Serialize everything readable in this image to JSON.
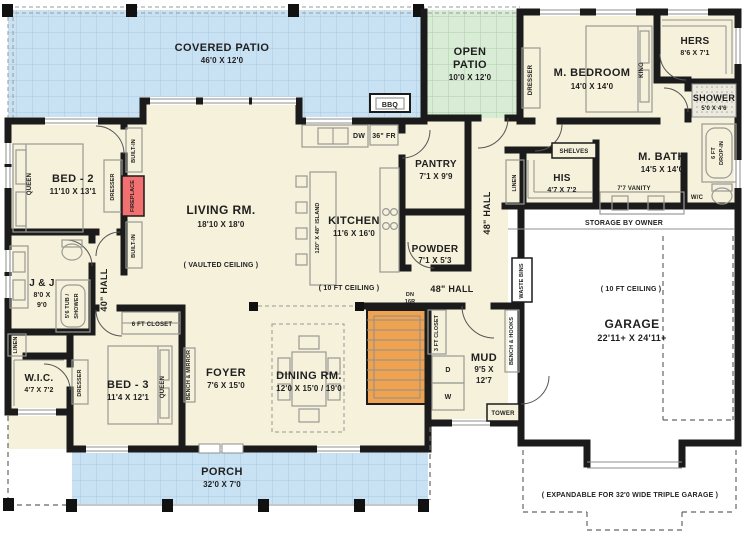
{
  "title": "One-Story House Floor Plan",
  "colors": {
    "patio_blue": "#c9e2f3",
    "patio_blue_grid": "#a6c8e0",
    "open_patio_green": "#d9ecd6",
    "open_patio_grid": "#abd0a6",
    "floor_cream": "#f5f1db",
    "wall_black": "#1b1b1b",
    "stairs_orange": "#efa24f",
    "fireplace_red": "#f37070",
    "garage_white": "#ffffff"
  },
  "rooms": {
    "covered_patio": {
      "name": "COVERED PATIO",
      "dims": "46'0 X 12'0"
    },
    "open_patio": {
      "line1": "OPEN",
      "line2": "PATIO",
      "dims": "10'0 X 12'0"
    },
    "m_bedroom": {
      "name": "M. BEDROOM",
      "dims": "14'0 X 14'0"
    },
    "hers": {
      "name": "HERS",
      "dims": "8'6 X 7'1"
    },
    "shower": {
      "name": "SHOWER",
      "dims": "5'0 X 4'6"
    },
    "m_bath": {
      "name": "M. BATH",
      "dims": "14'5 X 14'0"
    },
    "his": {
      "name": "HIS",
      "dims": "4'7 X 7'2"
    },
    "bed2": {
      "name": "BED - 2",
      "dims": "11'10 X 13'1"
    },
    "living": {
      "name": "LIVING RM.",
      "dims": "18'10 X 18'0",
      "note": "( VAULTED CEILING )"
    },
    "kitchen": {
      "name": "KITCHEN",
      "dims": "11'6 X 16'0"
    },
    "pantry": {
      "name": "PANTRY",
      "dims": "7'1 X 9'9"
    },
    "powder": {
      "name": "POWDER",
      "dims": "7'1 X 5'3"
    },
    "jack_jill": {
      "name": "J & J",
      "dims1": "8'0 X",
      "dims2": "9'0"
    },
    "wic": {
      "name": "W.I.C.",
      "dims": "4'7 X 7'2"
    },
    "bed3": {
      "name": "BED - 3",
      "dims": "11'4 X 12'1"
    },
    "foyer": {
      "name": "FOYER",
      "dims": "7'6 X 15'0"
    },
    "dining": {
      "name": "DINING RM.",
      "dims": "12'0 X 15'0 / 19'0"
    },
    "mud": {
      "name": "MUD",
      "dims1": "9'5 X",
      "dims2": "12'7"
    },
    "garage": {
      "name": "GARAGE",
      "dims": "22'11+ X 24'11+"
    },
    "porch": {
      "name": "PORCH",
      "dims": "32'0 X 7'0"
    }
  },
  "halls": {
    "hall40": "40\" HALL",
    "hall48_master": "48\" HALL",
    "hall48_stairs": "48\" HALL"
  },
  "notes": {
    "ceiling_kitchen": "( 10 FT CEILING )",
    "ceiling_garage": "( 10 FT CEILING )",
    "storage": "STORAGE BY OWNER",
    "expandable": "( EXPANDABLE FOR 32'0 WIDE TRIPLE GARAGE )",
    "stairs_dn": "DN",
    "stairs_risers": "16R"
  },
  "fixtures": {
    "queen_bed2": "QUEEN",
    "dresser_bed2": "DRESSER",
    "builtin_top": "BUILT-IN",
    "builtin_bottom": "BUILT-IN",
    "fireplace": "FIREPLACE",
    "island": "120\" X 48\" ISLAND",
    "dw": "DW",
    "fridge": "36\" FR",
    "bbq": "BBQ",
    "tub_shower_1": "5'6 TUB /",
    "tub_shower_2": "SHOWER",
    "linen_left": "LINEN",
    "linen_right": "LINEN",
    "dresser_bed3": "DRESSER",
    "queen_bed3": "QUEEN",
    "closet6": "6 FT CLOSET",
    "bench_mirror": "BENCH & MIRROR",
    "closet3": "3 FT CLOSET",
    "dryer": "D",
    "washer": "W",
    "tower": "TOWER",
    "bench_hooks": "BENCH & HOOKS",
    "waste_bins": "WASTE BINS",
    "shelves": "SHELVES",
    "vanity": "7'7 VANITY",
    "wc": "W/C",
    "dropin_1": "6 FT",
    "dropin_2": "DROP-IN",
    "king": "KING",
    "dresser_master": "DRESSER"
  }
}
